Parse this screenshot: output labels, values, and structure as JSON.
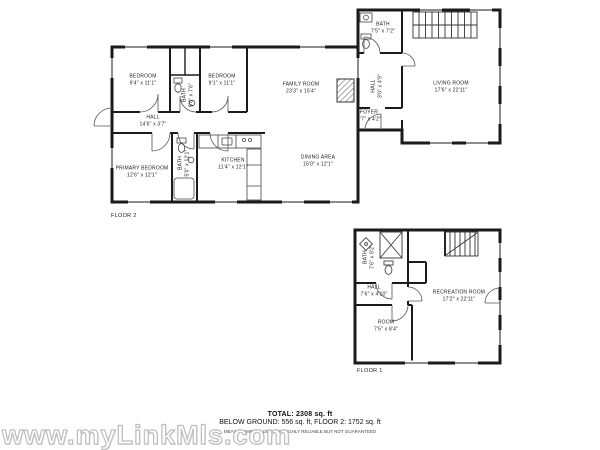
{
  "watermark": "www.myLinkMls.com",
  "summary": {
    "total": "TOTAL: 2308 sq. ft",
    "breakdown": "BELOW GROUND: 556 sq. ft, FLOOR 2: 1752 sq. ft",
    "disclaimer": "MEASUREMENTS DEEMED HIGHLY RELIABLE BUT NOT GUARANTEED"
  },
  "floor2": {
    "label": "FLOOR 2",
    "rooms": {
      "bedroom1": {
        "name": "BEDROOM",
        "dims": "9'4\" x 11'1\""
      },
      "bath_small": {
        "name": "BATH",
        "dims": "5'0\" x 7'6\""
      },
      "bedroom2": {
        "name": "BEDROOM",
        "dims": "9'1\" x 11'1\""
      },
      "family": {
        "name": "FAMILY ROOM",
        "dims": "23'3\" x 15'4\""
      },
      "hall": {
        "name": "HALL",
        "dims": "14'6\" x 3'7\""
      },
      "primary": {
        "name": "PRIMARY BEDROOM",
        "dims": "12'6\" x 12'1\""
      },
      "bath_main": {
        "name": "BATH",
        "dims": "5'0\" x 12'1\""
      },
      "kitchen": {
        "name": "KITCHEN",
        "dims": "11'4\" x 12'1\""
      },
      "dining": {
        "name": "DINING AREA",
        "dims": "15'0\" x 12'1\""
      },
      "foyer": {
        "name": "FOYER",
        "dims": "7'7\" x 4'2\""
      },
      "bath_upper": {
        "name": "BATH",
        "dims": "7'5\" x 7'2\""
      },
      "hall2": {
        "name": "HALL",
        "dims": "3'0\" x 4'9\""
      },
      "living": {
        "name": "LIVING ROOM",
        "dims": "17'6\" x 22'11\""
      }
    }
  },
  "floor1": {
    "label": "FLOOR 1",
    "rooms": {
      "bath": {
        "name": "BATH",
        "dims": "7'6\" x 9'2\""
      },
      "hall": {
        "name": "HALL",
        "dims": "7'6\" x 4'10\""
      },
      "recreation": {
        "name": "RECREATION ROOM",
        "dims": "17'2\" x 22'11\""
      },
      "room": {
        "name": "ROOM",
        "dims": "7'5\" x 8'4\""
      }
    }
  }
}
